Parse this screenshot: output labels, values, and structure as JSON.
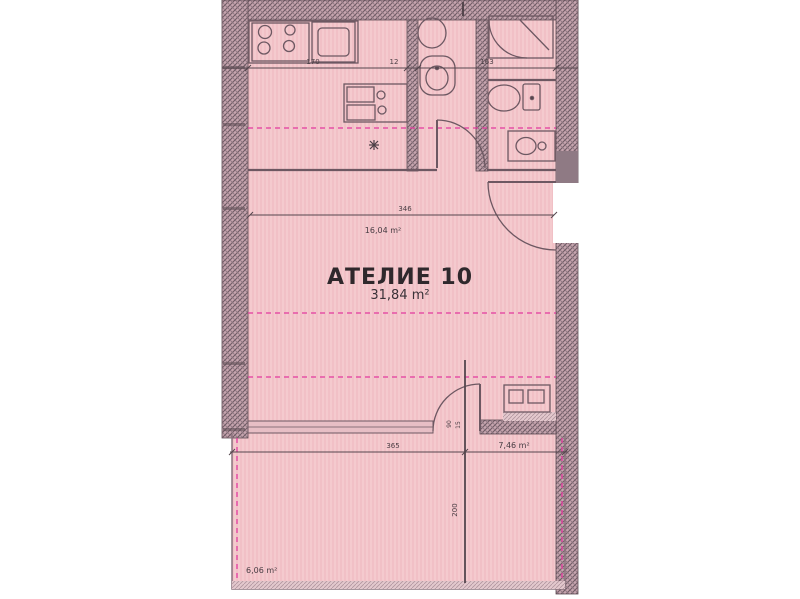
{
  "title": {
    "name": "АТЕЛИЕ 10",
    "area": "31,84 m²"
  },
  "areas": {
    "room": "16,04 m²",
    "balcony_left": "6,06 m²",
    "balcony_right": "7,46 m²"
  },
  "dimensions": {
    "top": [
      "170",
      "12",
      "163"
    ],
    "room_width": "346",
    "balcony_width": "365",
    "balcony_depth": "200",
    "door_width": "90",
    "door_offset": "15"
  },
  "colors": {
    "plan_pink": "#f4c6cb",
    "wall_hatch": "#c6a4ae",
    "line": "#6d5862",
    "dashed_magenta": "#e23a9e"
  }
}
